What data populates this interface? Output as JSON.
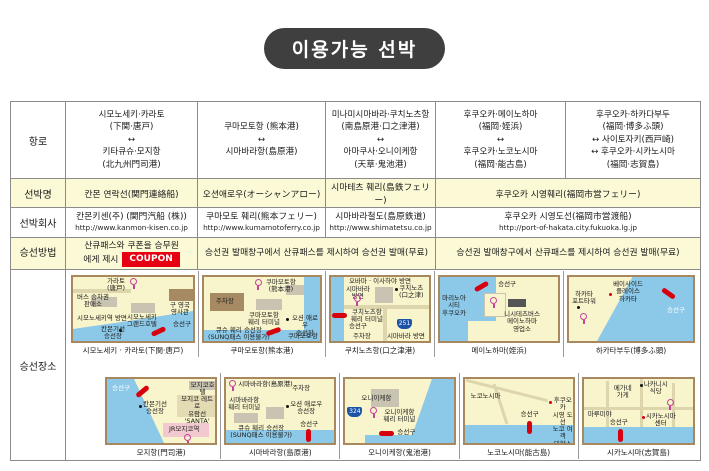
{
  "title": "이용가능 선박",
  "colors": {
    "title_bg": "#3f3f3f",
    "row_accent_yellow": "#fcf9d6",
    "coupon_badge_red": "#e60012",
    "map_water_blue": "#8cc8e8",
    "map_land_cream": "#f8f4cb",
    "boarding_marker_red": "#d7000f"
  },
  "table": {
    "row_labels": {
      "route": "항로",
      "ship_name": "선박명",
      "company": "선박회사",
      "boarding_method": "승선방법",
      "boarding_place": "승선장소"
    },
    "route": {
      "col1": "시모노세키·카라토\n(下関·唐戸)\n↔\n키타큐슈·모지항\n(北九州門司港)",
      "col2": "쿠마모토항 (熊本港)\n↔\n시마바라항(島原港)",
      "col3": "미나미시마바라·쿠치노츠항\n(南島原港·口之津港)\n↔\n아마쿠사·오니이케항\n(天草·鬼池港)",
      "col4": "후쿠오카·메이노하마\n(福岡·姪浜)\n↔\n후쿠오카·노코노시마\n(福岡·能古島)",
      "col5": "후쿠오카·하카다부두\n(福岡·博多ふ頭)\n↔ 사이토자키(西戸崎)\n↔ 후쿠오카·시카노시마\n(福岡·志賀島)"
    },
    "ship_name": {
      "col1": "칸몬 연락선(関門連絡船)",
      "col2": "오션애로우(オーシャンアロー)",
      "col3": "시마테츠 훼리(島鉄フェリー)",
      "col45": "후쿠오카 시영훼리(福岡市営フェリー)"
    },
    "company": {
      "col1": {
        "name": "칸몬키센(주) (関門汽船 (株))",
        "url": "http://www.kanmon-kisen.co.jp"
      },
      "col2": {
        "name": "쿠마모토 훼리(熊本フェリー)",
        "url": "http://www.kumamotoferry.co.jp"
      },
      "col3": {
        "name": "시마바라철도(島原鉄道)",
        "url": "http://www.shimatetsu.co.jp"
      },
      "col45": {
        "name": "후쿠오카 시영도선(福岡市営渡船)",
        "url": "http://port-of-hakata.city.fukuoka.lg.jp"
      }
    },
    "boarding_method": {
      "col1_line1": "산큐패스와 쿠폰을 승무원",
      "col1_line2": "에게 제시",
      "col1_badge": "COUPON",
      "col23": "승선권 발매창구에서 산큐패스를 제시하여 승선권 발매(무료)",
      "col45": "승선권 발매창구에서 산큐패스를 제시하여 승선권 발매(무료)"
    }
  },
  "maps": [
    {
      "caption": "시모노세키 · 카라토(下関·唐戸)",
      "labels": [
        "가라토\n(唐戸)",
        "구 영국\n영사관",
        "버스 승차권\n판매소",
        "시모노세키\n그랜드호텔",
        "시모노세키역 방면",
        "칸몬기선\n승선장",
        "승선구"
      ]
    },
    {
      "caption": "쿠마모토항(熊本港)",
      "labels": [
        "쿠마모토항\n(熊本港)",
        "주차장",
        "쿠마모토항\n훼리 터미널",
        "오션 애로우\n승선장",
        "큐슈 훼리 승선장\n(SUNQ패스 이용불가)",
        "쿠마모토항"
      ]
    },
    {
      "caption": "쿠치노츠항(口之津港)",
      "labels": [
        "오바마 · 이사하야 방면",
        "시마바라\n방면",
        "쿠치노츠항\n훼리 터미널",
        "쿠치노츠\n(口之津)",
        "승선구",
        "주차장",
        "시마바라 방면"
      ],
      "route_badge": "251"
    },
    {
      "caption": "메이노하마(姪浜)",
      "labels": [
        "승선구",
        "마리노아\n시티\n후쿠오카",
        "니시테츠버스\n메이노하마\n영업소"
      ]
    },
    {
      "caption": "하카타부두(博多ふ頭)",
      "labels": [
        "하카타\n포트타워",
        "베이사이드\n플레이스\n하카타",
        "승선구"
      ]
    },
    {
      "caption": "모지항(門司港)",
      "labels": [
        "승선구",
        "칸몬기선\n승선장",
        "모지코호텔",
        "모지코 레트로\n유람선 'SANTA'\n승선장",
        "JR모지코역"
      ]
    },
    {
      "caption": "시마바라항(島原港)",
      "labels": [
        "시마바라항(島原港)",
        "주차장",
        "시마바라항\n훼리 터미널",
        "오션 애로우\n승선장",
        "큐슈 훼리 승선장\n(SUNQ패스 이용불가)",
        "승선구"
      ]
    },
    {
      "caption": "오니이케항(鬼池港)",
      "labels": [
        "오니이케항",
        "오니이케항\n훼리 터미널",
        "승선구"
      ],
      "route_badge": "324"
    },
    {
      "caption": "노코노시마(能古島)",
      "labels": [
        "노코노시마",
        "승선구",
        "후쿠오카\n시영 도선\n노코 여객\n대합소"
      ]
    },
    {
      "caption": "시카노시마(志賀島)",
      "labels": [
        "나카니시\n식당",
        "메가네\n가게",
        "마루미야",
        "시카노시마\n센터",
        "승선구"
      ]
    }
  ]
}
